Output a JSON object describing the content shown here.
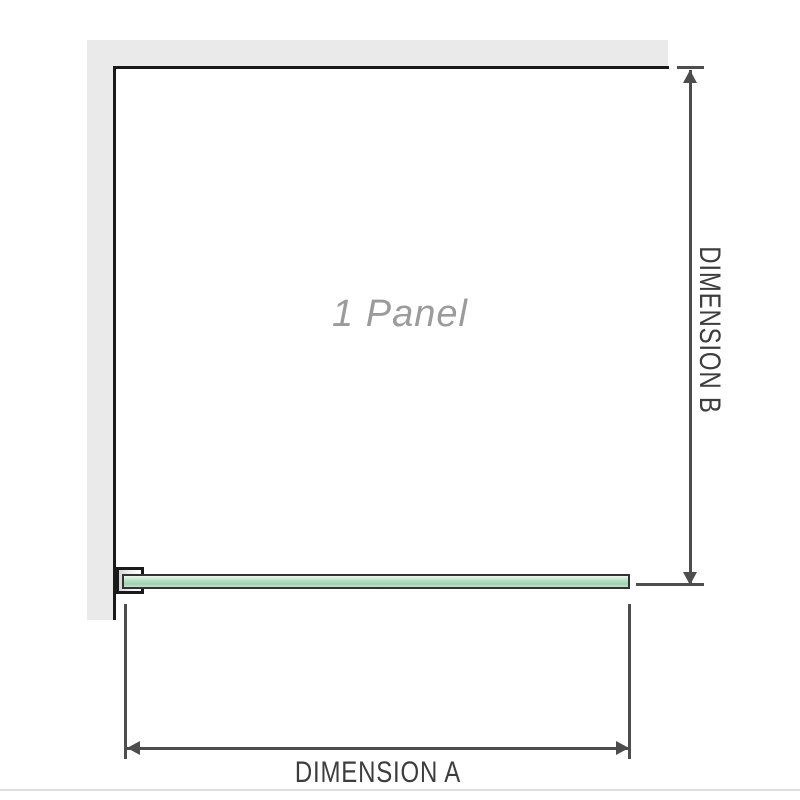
{
  "diagram": {
    "type": "shower-screen-dimension-diagram",
    "panel_label": "1 Panel",
    "dimension_a_label": "DIMENSION A",
    "dimension_b_label": "DIMENSION B"
  },
  "colors": {
    "wall_fill": "#eaeaea",
    "wall_edge": "#1a1a1a",
    "bracket_fill": "#d6d6d6",
    "glass_fill": "#b4dfc2",
    "glass_fill_light": "#eef7f0",
    "glass_border": "#333333",
    "dimension_line": "#4d4d4d",
    "dimension_text": "#3d3d3d",
    "panel_text": "#9b9b9b",
    "bottom_edge": "#dedede"
  }
}
